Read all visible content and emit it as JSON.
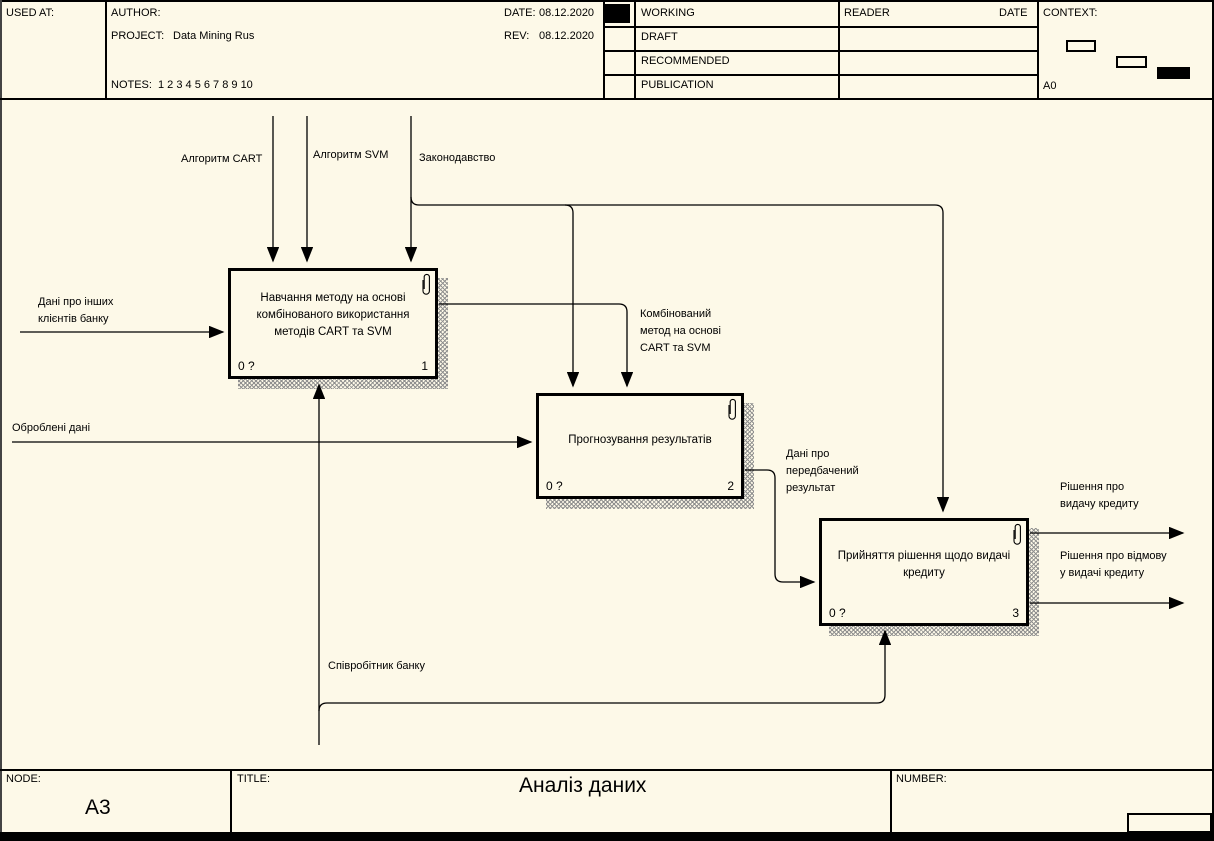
{
  "header": {
    "used_at_label": "USED AT:",
    "author_label": "AUTHOR:",
    "project_label": "PROJECT:",
    "project_value": "Data Mining Rus",
    "notes_label": "NOTES:",
    "notes_values": "1 2 3 4 5 6 7 8 9 10",
    "date_label": "DATE:",
    "date_value": "08.12.2020",
    "rev_label": "REV:",
    "rev_value": "08.12.2020",
    "status_rows": [
      "WORKING",
      "DRAFT",
      "RECOMMENDED",
      "PUBLICATION"
    ],
    "reader_label": "READER",
    "reader_date_label": "DATE",
    "context_label": "CONTEXT:",
    "context_node": "A0"
  },
  "diagram": {
    "boxes": [
      {
        "label": "Навчання методу на основі комбінованого використання методів CART та SVM",
        "code": "0 ?",
        "number": "1"
      },
      {
        "label": "Прогнозування результатів",
        "code": "0 ?",
        "number": "2"
      },
      {
        "label": "Прийняття рішення щодо видачі кредиту",
        "code": "0 ?",
        "number": "3"
      }
    ],
    "arrows": {
      "cart": "Алгоритм CART",
      "svm": "Алгоритм SVM",
      "law": "Законодавство",
      "other_clients": "Дані про інших клієнтів банку",
      "processed": "Оброблені дані",
      "combined": "Комбінований метод на основі CART та SVM",
      "predicted": "Дані про передбачений результат",
      "grant": "Рішення про видачу кредиту",
      "refuse": "Рішення про відмову у видачі кредиту",
      "employee": "Співробітник банку"
    }
  },
  "footer": {
    "node_label": "NODE:",
    "node_value": "A3",
    "title_label": "TITLE:",
    "title_value": "Аналіз даних",
    "number_label": "NUMBER:"
  }
}
